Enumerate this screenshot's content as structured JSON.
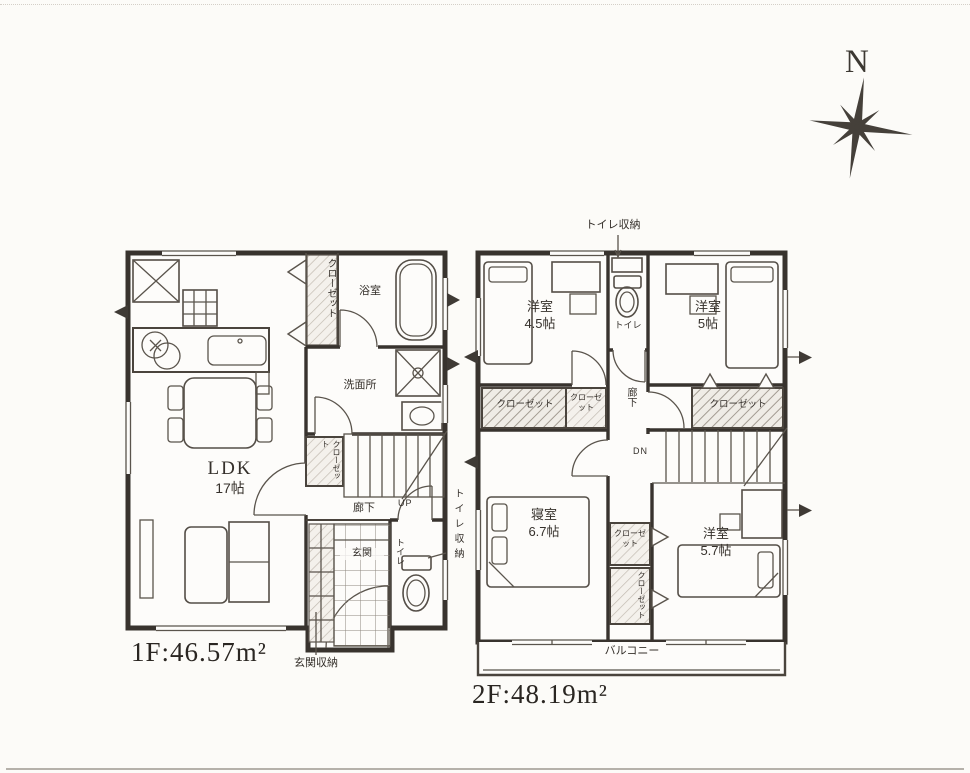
{
  "compass": {
    "north": "N"
  },
  "floor1": {
    "area": "1F:46.57m²",
    "ldk": {
      "name": "LDK",
      "size": "17帖"
    },
    "closet": "クローゼット",
    "bath": "浴室",
    "washroom": "洗面所",
    "closet_small": "クローゼット",
    "hallway": "廊下",
    "stairs_up": "UP",
    "toilet": "トイレ",
    "entrance": "玄関",
    "entrance_storage": "玄関収納",
    "toilet_storage": "トイレ収納"
  },
  "floor2": {
    "area": "2F:48.19m²",
    "toilet_storage": "トイレ収納",
    "room_a": {
      "name": "洋室",
      "size": "4.5帖"
    },
    "toilet": "トイレ",
    "room_b": {
      "name": "洋室",
      "size": "5帖"
    },
    "closet_left": "クローゼット",
    "closet_mid": "クローゼット",
    "hallway": "廊下",
    "closet_right": "クローゼット",
    "stairs_down": "DN",
    "bedroom": {
      "name": "寝室",
      "size": "6.7帖"
    },
    "closet_c1": "クローゼット",
    "closet_c2": "クローゼット",
    "room_c": {
      "name": "洋室",
      "size": "5.7帖"
    },
    "balcony": "バルコニー"
  }
}
